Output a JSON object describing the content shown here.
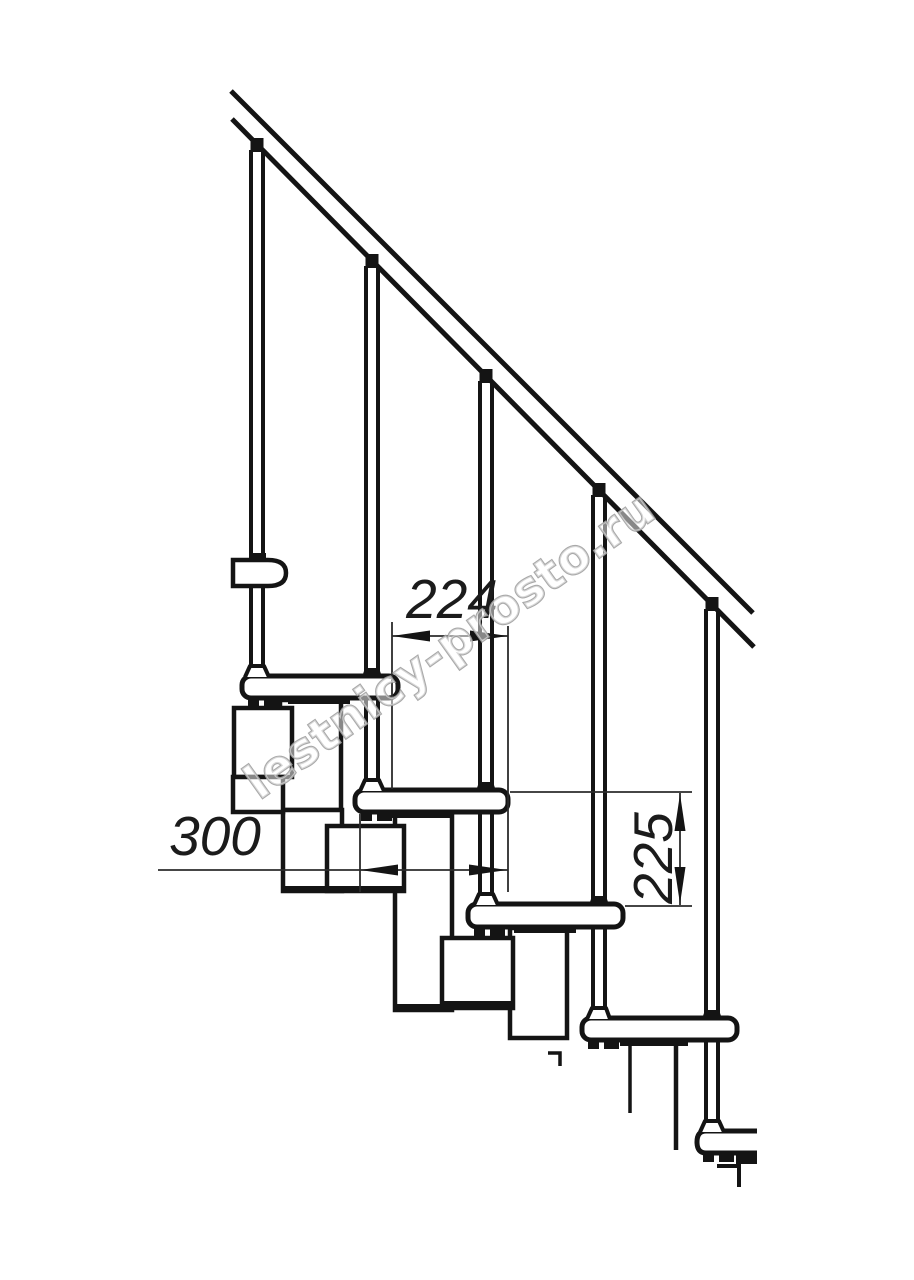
{
  "page": {
    "background": "#ffffff",
    "width": 914,
    "height": 1280
  },
  "drawing": {
    "kind": "modular-staircase-side-elevation",
    "line_color": "#141414",
    "dimension_color": "#2b2b2b",
    "dimensions": {
      "going": "224",
      "tread_depth": "300",
      "riser_height": "225"
    },
    "watermark": {
      "text": "lestnicy-prosto.ru",
      "color": "#a0a0a0"
    },
    "counts": {
      "balusters": 5,
      "treads": 5,
      "handrail_segments": 1
    }
  }
}
